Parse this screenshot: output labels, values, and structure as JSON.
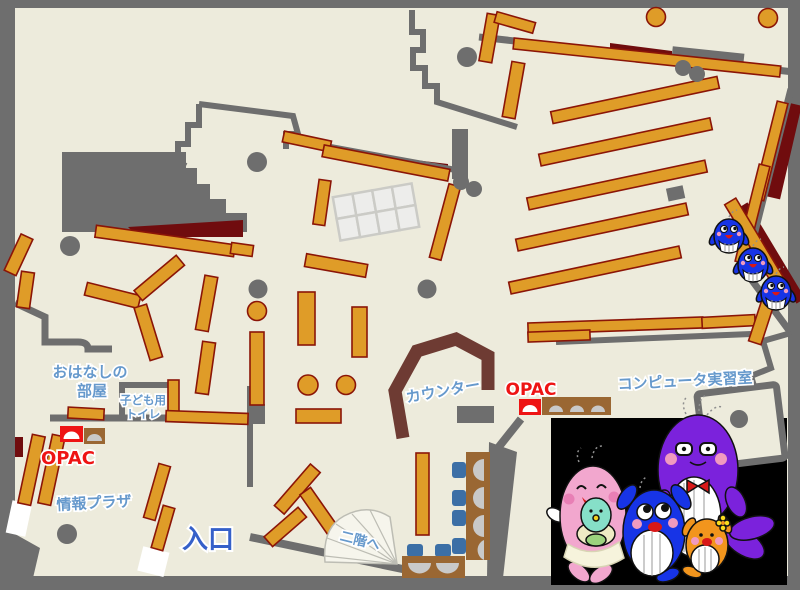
{
  "map": {
    "labels": {
      "storytelling_room": [
        "おはなしの",
        "部屋"
      ],
      "kids_toilet": [
        "子ども用",
        "トイレ"
      ],
      "opac_children_area": "OPAC",
      "opac_counter_area": "OPAC",
      "info_plaza": "情報プラザ",
      "entrance": "入口",
      "counter": "カウンター",
      "computer_room": "コンピュータ実習室",
      "to_second_floor": "二階へ"
    },
    "icons": {
      "family_photo": "whale-mascot-family",
      "right_edge_mascots": "three-small-blue-whales",
      "opac_terminal": "terminal-with-arch-screen",
      "stairs": "fan-shaped-staircase"
    },
    "colors": {
      "floor": "#EDEBDC",
      "wall": "#6E6E6E",
      "shelf": "#DF9C28",
      "shelf_border": "#8B1507",
      "dark_red": "#700C0E",
      "counter_wood": "#6E3B33",
      "label_blue": "#6699CC",
      "entrance_blue": "#3560C9",
      "opac_red": "#EE1414",
      "desk_brown": "#9A6733",
      "chair_blue": "#3C6FA6",
      "seat_gray": "#C9C9C9",
      "photo_bg": "#000000",
      "door_white": "#FFFFFF",
      "grid_cell": "#EDEDEB",
      "grid_line": "#CBCBC6",
      "stairs_fill": "#F6F5EC",
      "stairs_line": "#BDBDB4",
      "whale_blue": "#1734E6",
      "mama_pink": "#F2A7CE",
      "papa_purple": "#7B22DC",
      "baby_teal": "#86DFC8",
      "kid_orange": "#F2951D",
      "blanket_cream": "#EFEBC4",
      "cheek_pink": "#F09ABF",
      "mouth_red": "#D81818"
    }
  }
}
